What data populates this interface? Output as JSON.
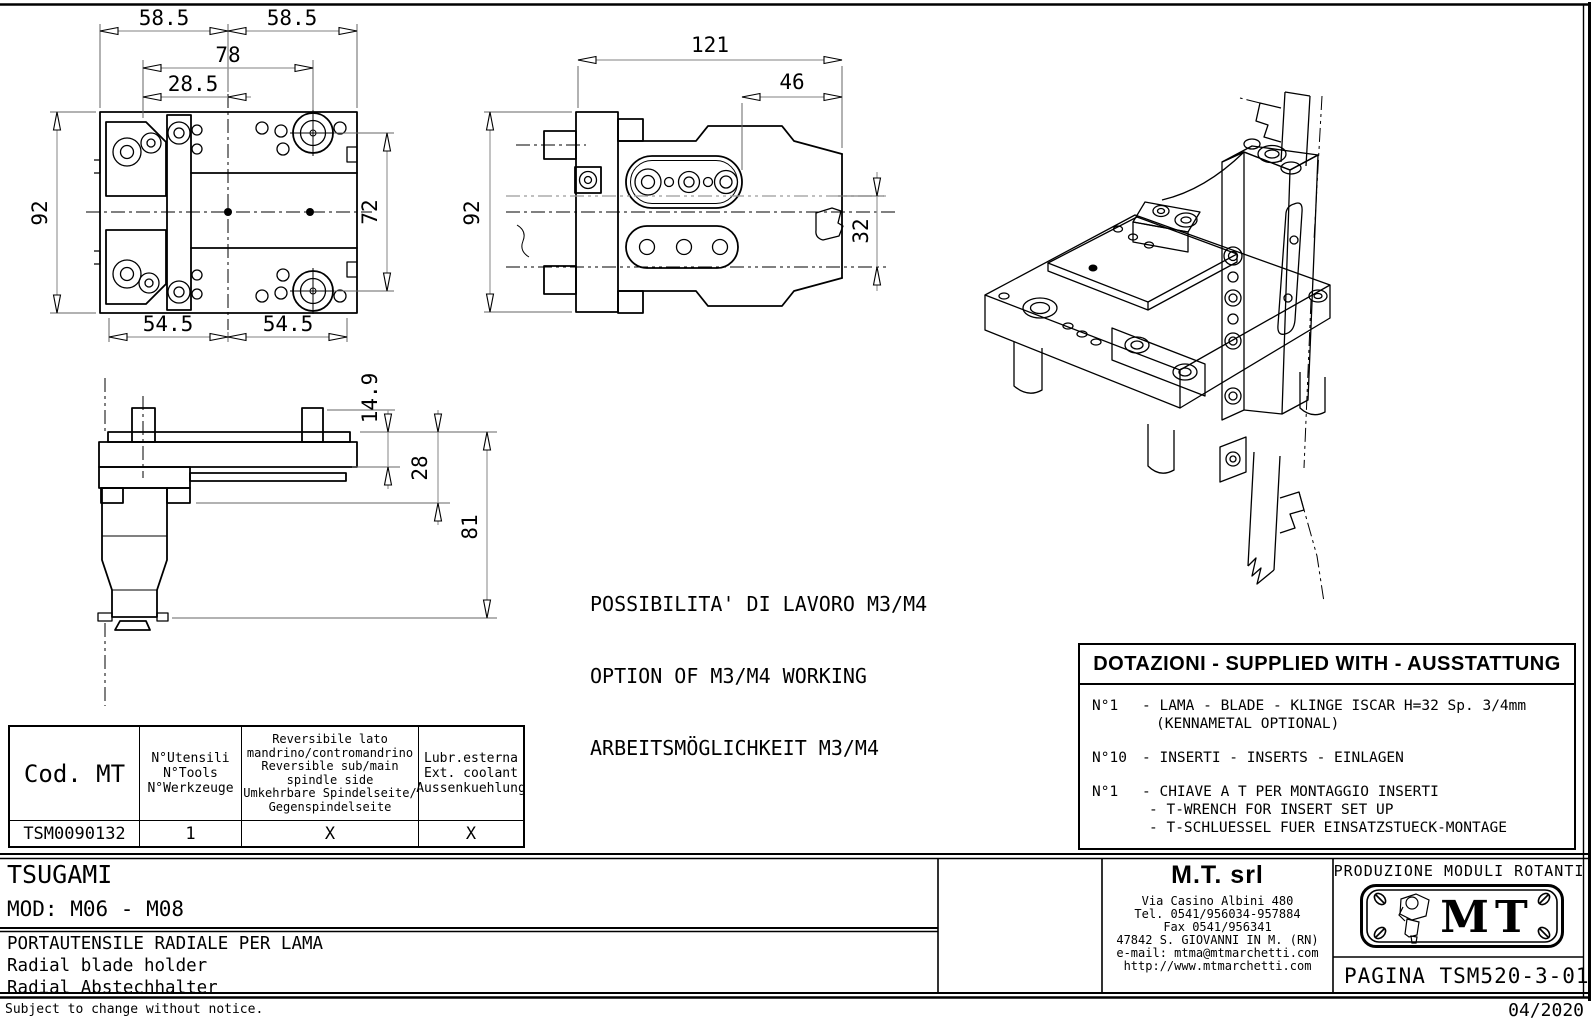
{
  "plan_view": {
    "w1": "58.5",
    "w2": "58.5",
    "w3": "78",
    "w4": "28.5",
    "h1": "92",
    "h2": "72",
    "b1": "54.5",
    "b2": "54.5"
  },
  "side_view": {
    "w1": "121",
    "w2": "46",
    "h1": "92",
    "h2": "32"
  },
  "front_view": {
    "v1": "14.9",
    "v2": "28",
    "v3": "81"
  },
  "notes": {
    "line1": "POSSIBILITA' DI LAVORO M3/M4",
    "line2": "OPTION OF M3/M4 WORKING",
    "line3": "ARBEITSMÖGLICHKEIT M3/M4"
  },
  "supplied_with": {
    "title": "DOTAZIONI - SUPPLIED WITH - AUSSTATTUNG",
    "items": [
      {
        "qty": "N°1",
        "line1": "- LAMA - BLADE - KLINGE ISCAR H=32 Sp. 3/4mm",
        "line2": "(KENNAMETAL OPTIONAL)"
      },
      {
        "qty": "N°10",
        "line1": "- INSERTI - INSERTS - EINLAGEN"
      },
      {
        "qty": "N°1",
        "line1": "- CHIAVE A T PER MONTAGGIO INSERTI",
        "line2": "- T-WRENCH FOR INSERT SET UP",
        "line3": "- T-SCHLUESSEL FUER EINSATZSTUECK-MONTAGE"
      }
    ]
  },
  "spec_table": {
    "col1_header": "Cod. MT",
    "col2_header_lines": [
      "N°Utensili",
      "N°Tools",
      "N°Werkzeuge"
    ],
    "col3_header_lines": [
      "Reversibile lato",
      "mandrino/contromandrino",
      "Reversible sub/main",
      "spindle side",
      "Umkehrbare Spindelseite/",
      "Gegenspindelseite"
    ],
    "col4_header_lines": [
      "Lubr.esterna",
      "Ext. coolant",
      "Aussenkuehlung"
    ],
    "row": {
      "code": "TSM0090132",
      "tools": "1",
      "reversible": "X",
      "coolant": "X"
    }
  },
  "title_block": {
    "brand": "TSUGAMI",
    "model": "MOD: M06 - M08",
    "desc_it": "PORTAUTENSILE RADIALE PER LAMA",
    "desc_en": "Radial blade holder",
    "desc_de": "Radial Abstechhalter",
    "mfr_name": "M.T. srl",
    "mfr_address": [
      "Via Casino Albini 480",
      "Tel. 0541/956034-957884",
      "Fax 0541/956341",
      "47842 S. GIOVANNI IN M. (RN)",
      "e-mail: mtma@mtmarchetti.com",
      "http://www.mtmarchetti.com"
    ],
    "production_label": "PRODUZIONE MODULI ROTANTI",
    "logo_text": "MT",
    "page_label": "PAGINA TSM520-3-01"
  },
  "footer": {
    "change_note": "Subject to change without notice.",
    "date": "04/2020"
  },
  "colors": {
    "line": "#000000",
    "dim_line": "#9a9a9a",
    "background": "#ffffff"
  }
}
